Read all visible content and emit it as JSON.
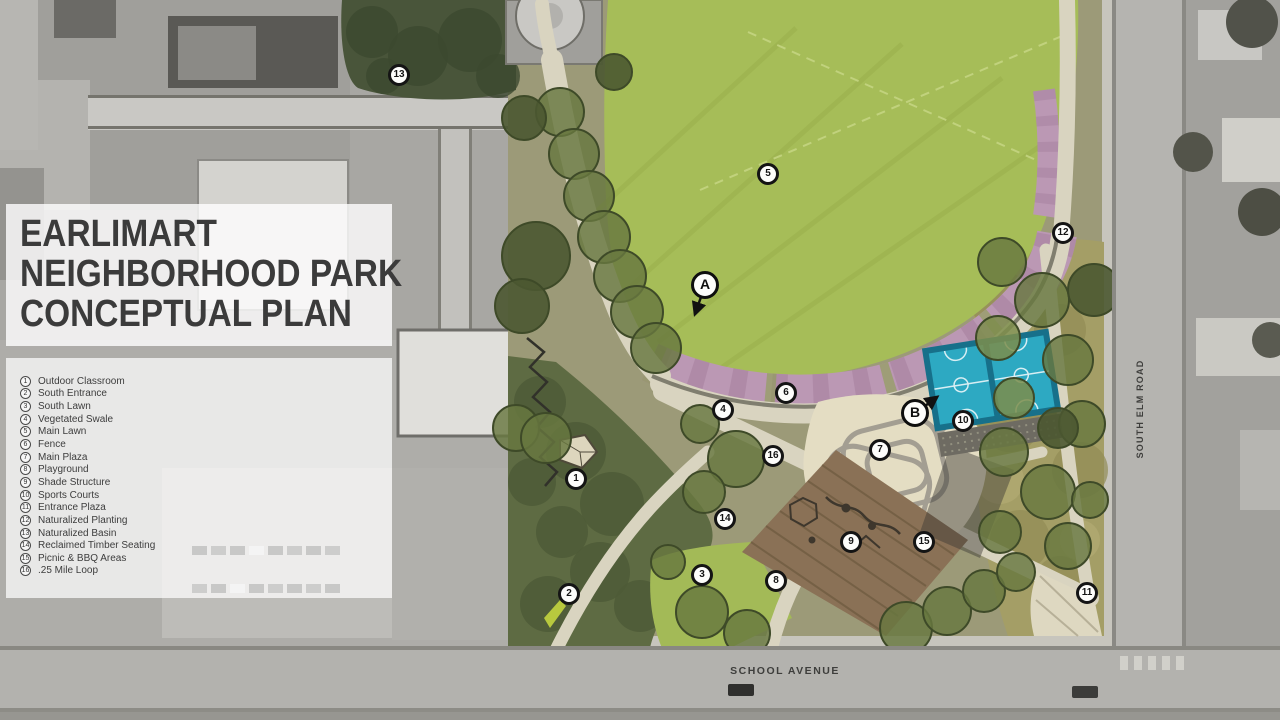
{
  "title": {
    "lines": [
      "EARLIMART",
      "NEIGHBORHOOD PARK",
      "CONCEPTUAL PLAN"
    ]
  },
  "legend": {
    "items": [
      {
        "num": "1",
        "label": "Outdoor Classroom"
      },
      {
        "num": "2",
        "label": "South Entrance"
      },
      {
        "num": "3",
        "label": "South Lawn"
      },
      {
        "num": "4",
        "label": "Vegetated Swale"
      },
      {
        "num": "5",
        "label": "Main Lawn"
      },
      {
        "num": "6",
        "label": "Fence"
      },
      {
        "num": "7",
        "label": "Main Plaza"
      },
      {
        "num": "8",
        "label": "Playground"
      },
      {
        "num": "9",
        "label": "Shade Structure"
      },
      {
        "num": "10",
        "label": "Sports Courts"
      },
      {
        "num": "11",
        "label": "Entrance Plaza"
      },
      {
        "num": "12",
        "label": "Naturalized Planting"
      },
      {
        "num": "13",
        "label": "Naturalized Basin"
      },
      {
        "num": "14",
        "label": "Reclaimed Timber Seating"
      },
      {
        "num": "15",
        "label": "Picnic & BBQ Areas"
      },
      {
        "num": "16",
        "label": ".25 Mile Loop"
      }
    ]
  },
  "roads": {
    "south_elm_road": "SOUTH ELM ROAD",
    "school_avenue": "SCHOOL AVENUE"
  },
  "map": {
    "markers": [
      {
        "label": "1",
        "x": 576,
        "y": 479
      },
      {
        "label": "2",
        "x": 569,
        "y": 594
      },
      {
        "label": "3",
        "x": 702,
        "y": 575
      },
      {
        "label": "4",
        "x": 723,
        "y": 410
      },
      {
        "label": "5",
        "x": 768,
        "y": 174
      },
      {
        "label": "6",
        "x": 786,
        "y": 393
      },
      {
        "label": "7",
        "x": 880,
        "y": 450
      },
      {
        "label": "8",
        "x": 776,
        "y": 581
      },
      {
        "label": "9",
        "x": 851,
        "y": 542
      },
      {
        "label": "10",
        "x": 963,
        "y": 421
      },
      {
        "label": "11",
        "x": 1087,
        "y": 593
      },
      {
        "label": "12",
        "x": 1063,
        "y": 233
      },
      {
        "label": "13",
        "x": 399,
        "y": 75
      },
      {
        "label": "14",
        "x": 725,
        "y": 519
      },
      {
        "label": "15",
        "x": 924,
        "y": 542
      },
      {
        "label": "16",
        "x": 773,
        "y": 456
      }
    ],
    "callouts": [
      {
        "label": "A",
        "x": 705,
        "y": 285
      },
      {
        "label": "B",
        "x": 915,
        "y": 413
      }
    ]
  },
  "colors": {
    "main_lawn_green": "#a6bd58",
    "sports_court_teal": "#2da9c2",
    "playground_brown": "#8a7156",
    "swale_pink": "#bb98b4",
    "path_tan": "#d9d4c0",
    "aerial_gray": "#a8a7a3",
    "title_text": "#3b3b3b"
  }
}
